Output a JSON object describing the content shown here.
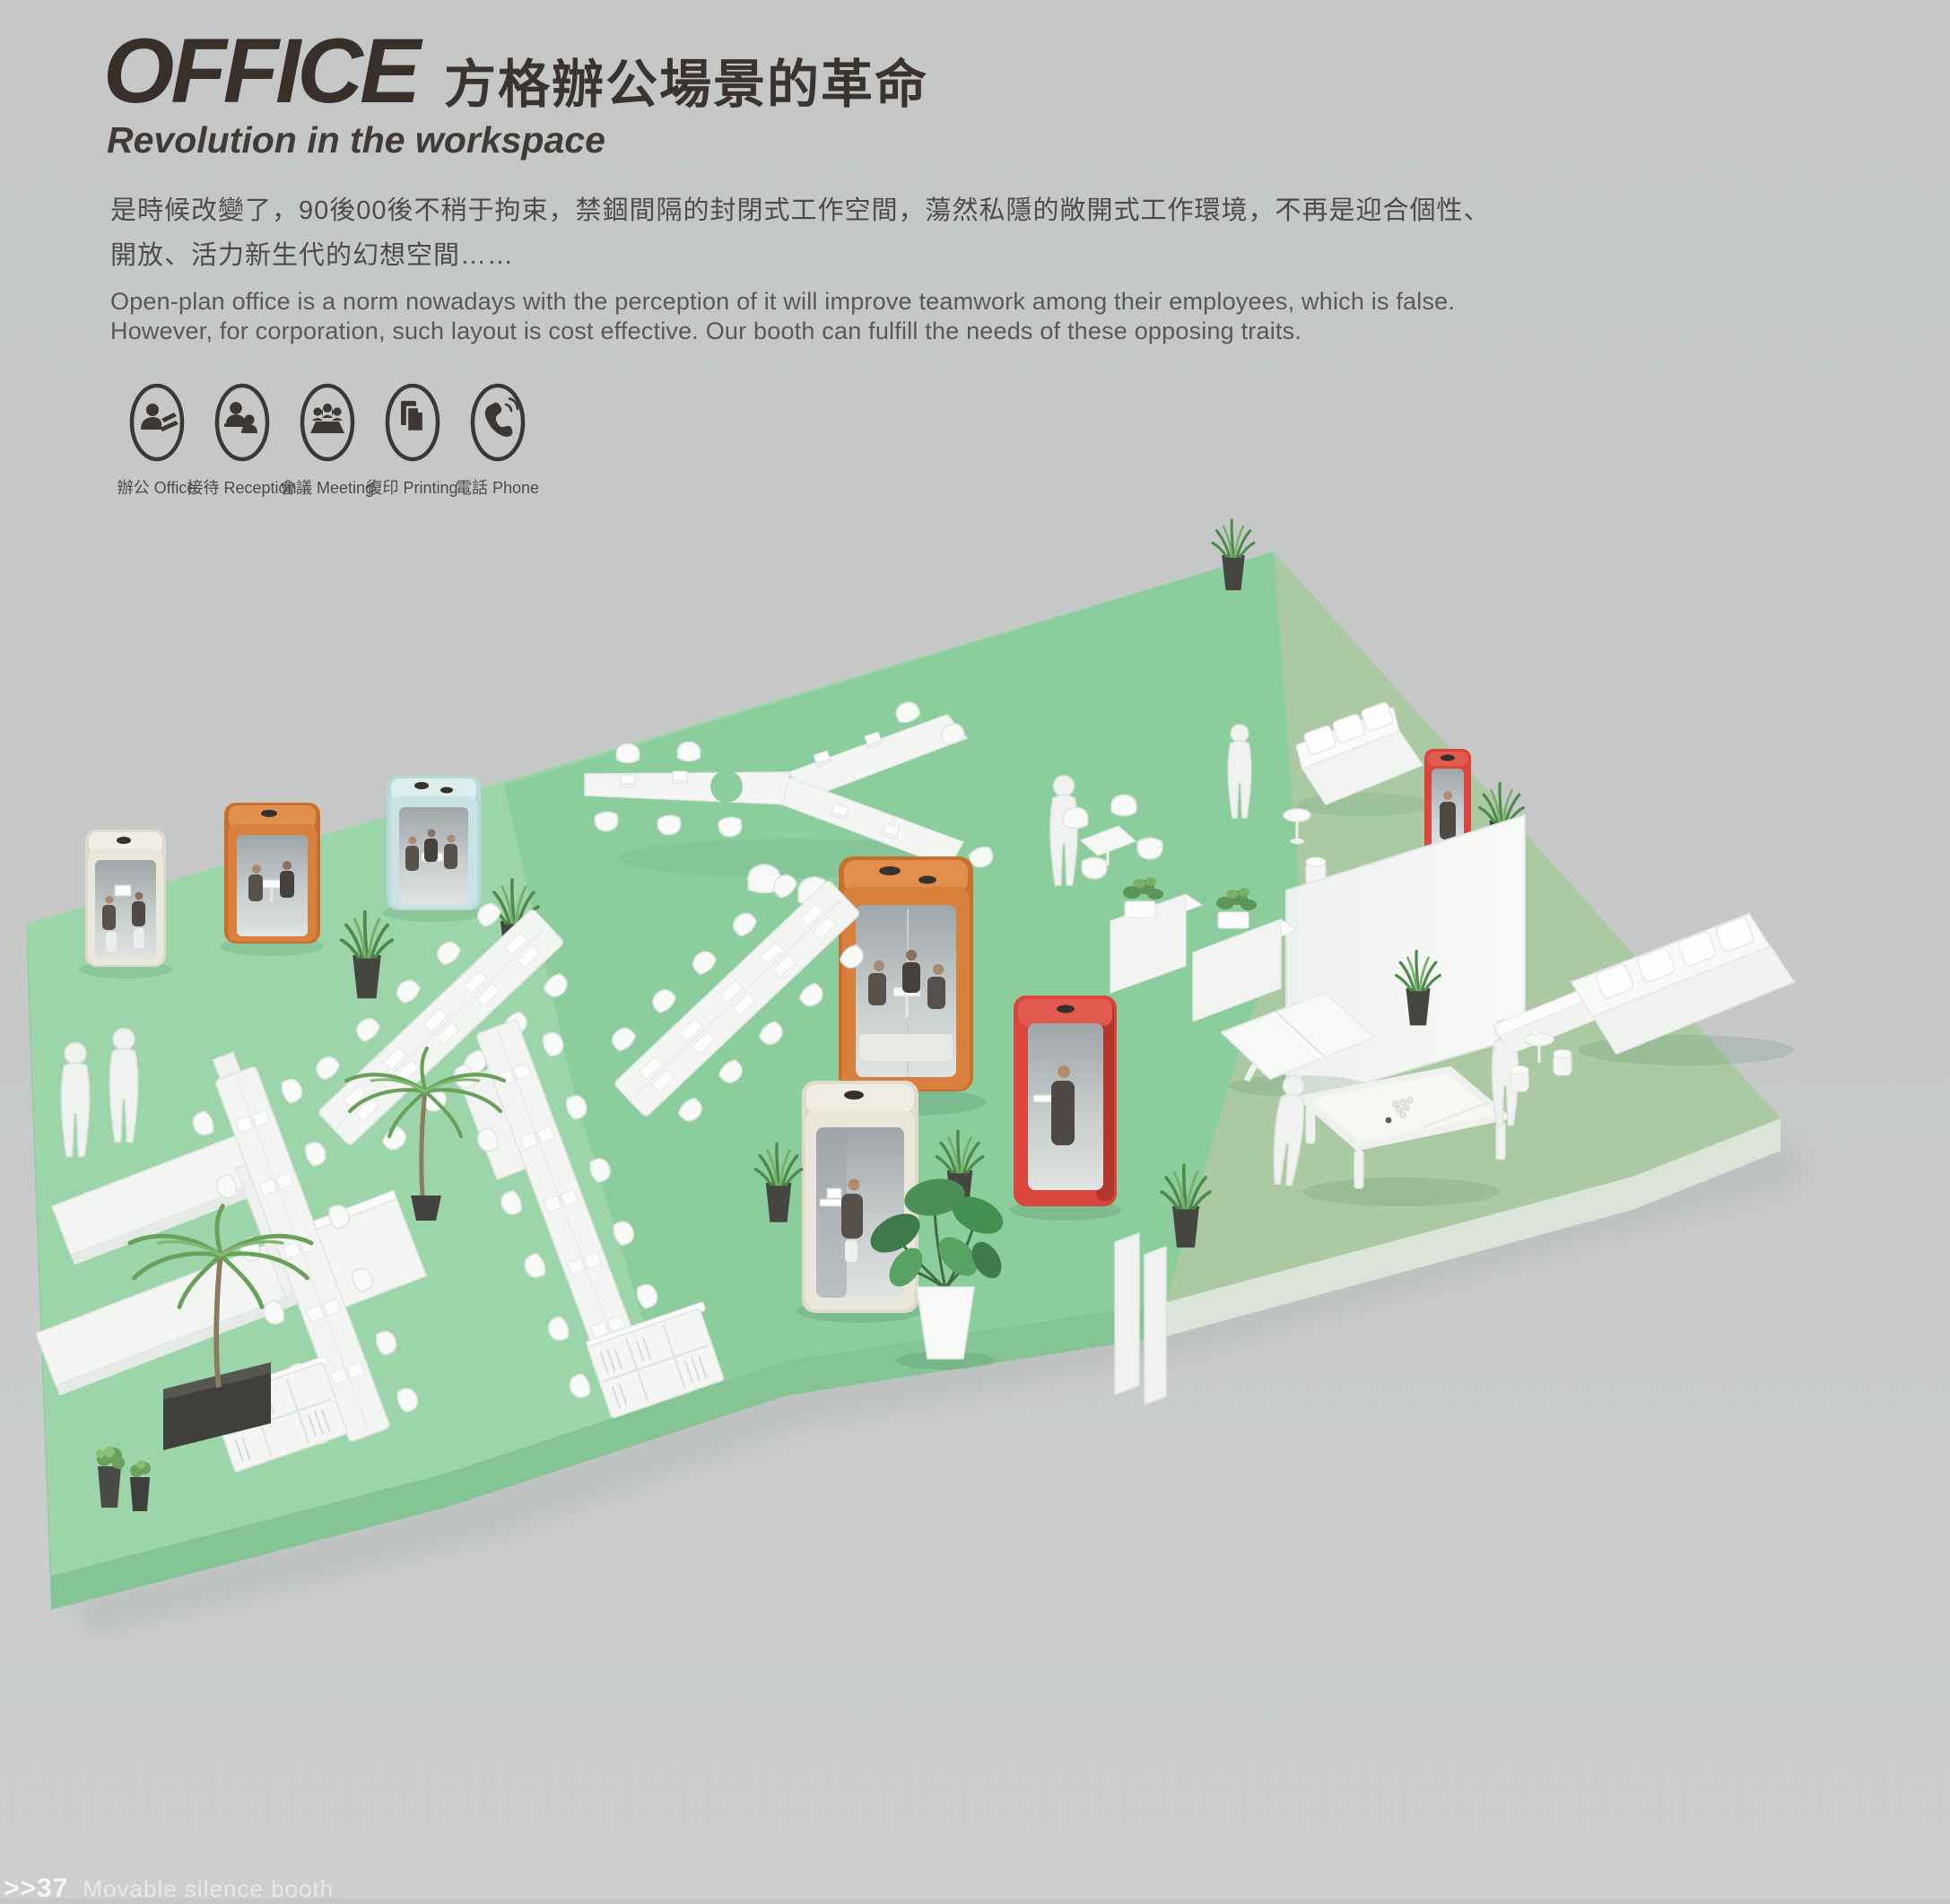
{
  "header": {
    "title_en": "OFFICE",
    "title_zh": "方格辦公場景的革命",
    "subtitle": "Revolution in the workspace",
    "paragraph_zh_line1": "是時候改變了，90後00後不稍于拘束，禁錮間隔的封閉式工作空間，蕩然私隱的敞開式工作環境，不再是迎合個性、",
    "paragraph_zh_line2": "開放、活力新生代的幻想空間……",
    "paragraph_en_line1": "Open-plan office is a norm nowadays with the perception of it will improve teamwork among their employees, which is false.",
    "paragraph_en_line2": "However, for corporation, such layout is cost effective. Our booth can fulfill the needs of these opposing traits."
  },
  "features": [
    {
      "icon": "office-person-icon",
      "label": "辦公 Office"
    },
    {
      "icon": "reception-icon",
      "label": "接待 Reception"
    },
    {
      "icon": "meeting-icon",
      "label": "會議 Meeting"
    },
    {
      "icon": "printing-icon",
      "label": "復印 Printing"
    },
    {
      "icon": "phone-icon",
      "label": "電話 Phone"
    }
  ],
  "footer": {
    "page_marker": ">>37",
    "caption": "Movable silence booth"
  },
  "scene": {
    "floor_colors": {
      "left": "#9bd5a9",
      "middle": "#8ccd9e",
      "right": "#abc9a3"
    },
    "booth_colors": {
      "cream": "#eae6da",
      "orange": "#d9803c",
      "blue": "#c9e2e4",
      "red": "#d8463e"
    },
    "booths": [
      {
        "name": "silence-booth-small-cream"
      },
      {
        "name": "silence-booth-small-orange"
      },
      {
        "name": "silence-booth-small-blue"
      },
      {
        "name": "silence-booth-large-orange"
      },
      {
        "name": "silence-booth-phone-red"
      },
      {
        "name": "silence-booth-work-cream"
      },
      {
        "name": "silence-booth-phone-red-lounge"
      }
    ]
  }
}
